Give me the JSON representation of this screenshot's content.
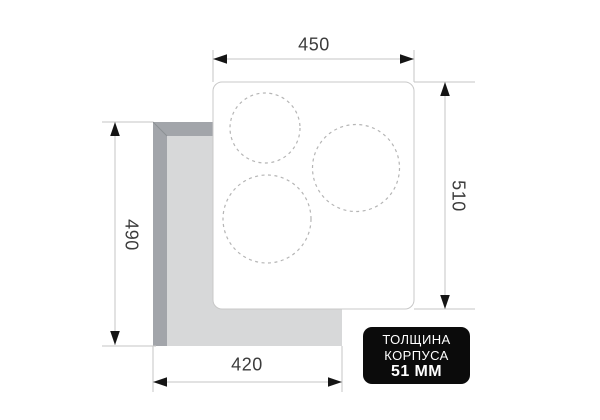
{
  "diagram_type": "hob-installation-dimensions",
  "dimensions": {
    "top_width": "450",
    "right_depth": "510",
    "left_cutout_height": "490",
    "bottom_cutout_width": "420"
  },
  "badge": {
    "line1": "ТОЛЩИНА",
    "line2": "КОРПУСА",
    "line3": "51 ММ"
  },
  "burners": [
    {
      "name": "burner-top-left",
      "radius_px": 35
    },
    {
      "name": "burner-right",
      "radius_px": 43.5
    },
    {
      "name": "burner-bottom-left",
      "radius_px": 44
    }
  ],
  "colors": {
    "badge_bg": "#0b0b0b",
    "badge_text": "#ffffff",
    "cutout_light": "#d7d8d9",
    "cutout_dark": "#a2a5aa",
    "panel_fill": "#ffffff",
    "panel_border": "#c8c8c8",
    "dim_line": "#c6c6c6",
    "arrowhead": "#151515",
    "label_text": "#3c3c3c",
    "burner_dash": "#b5b5b5"
  }
}
